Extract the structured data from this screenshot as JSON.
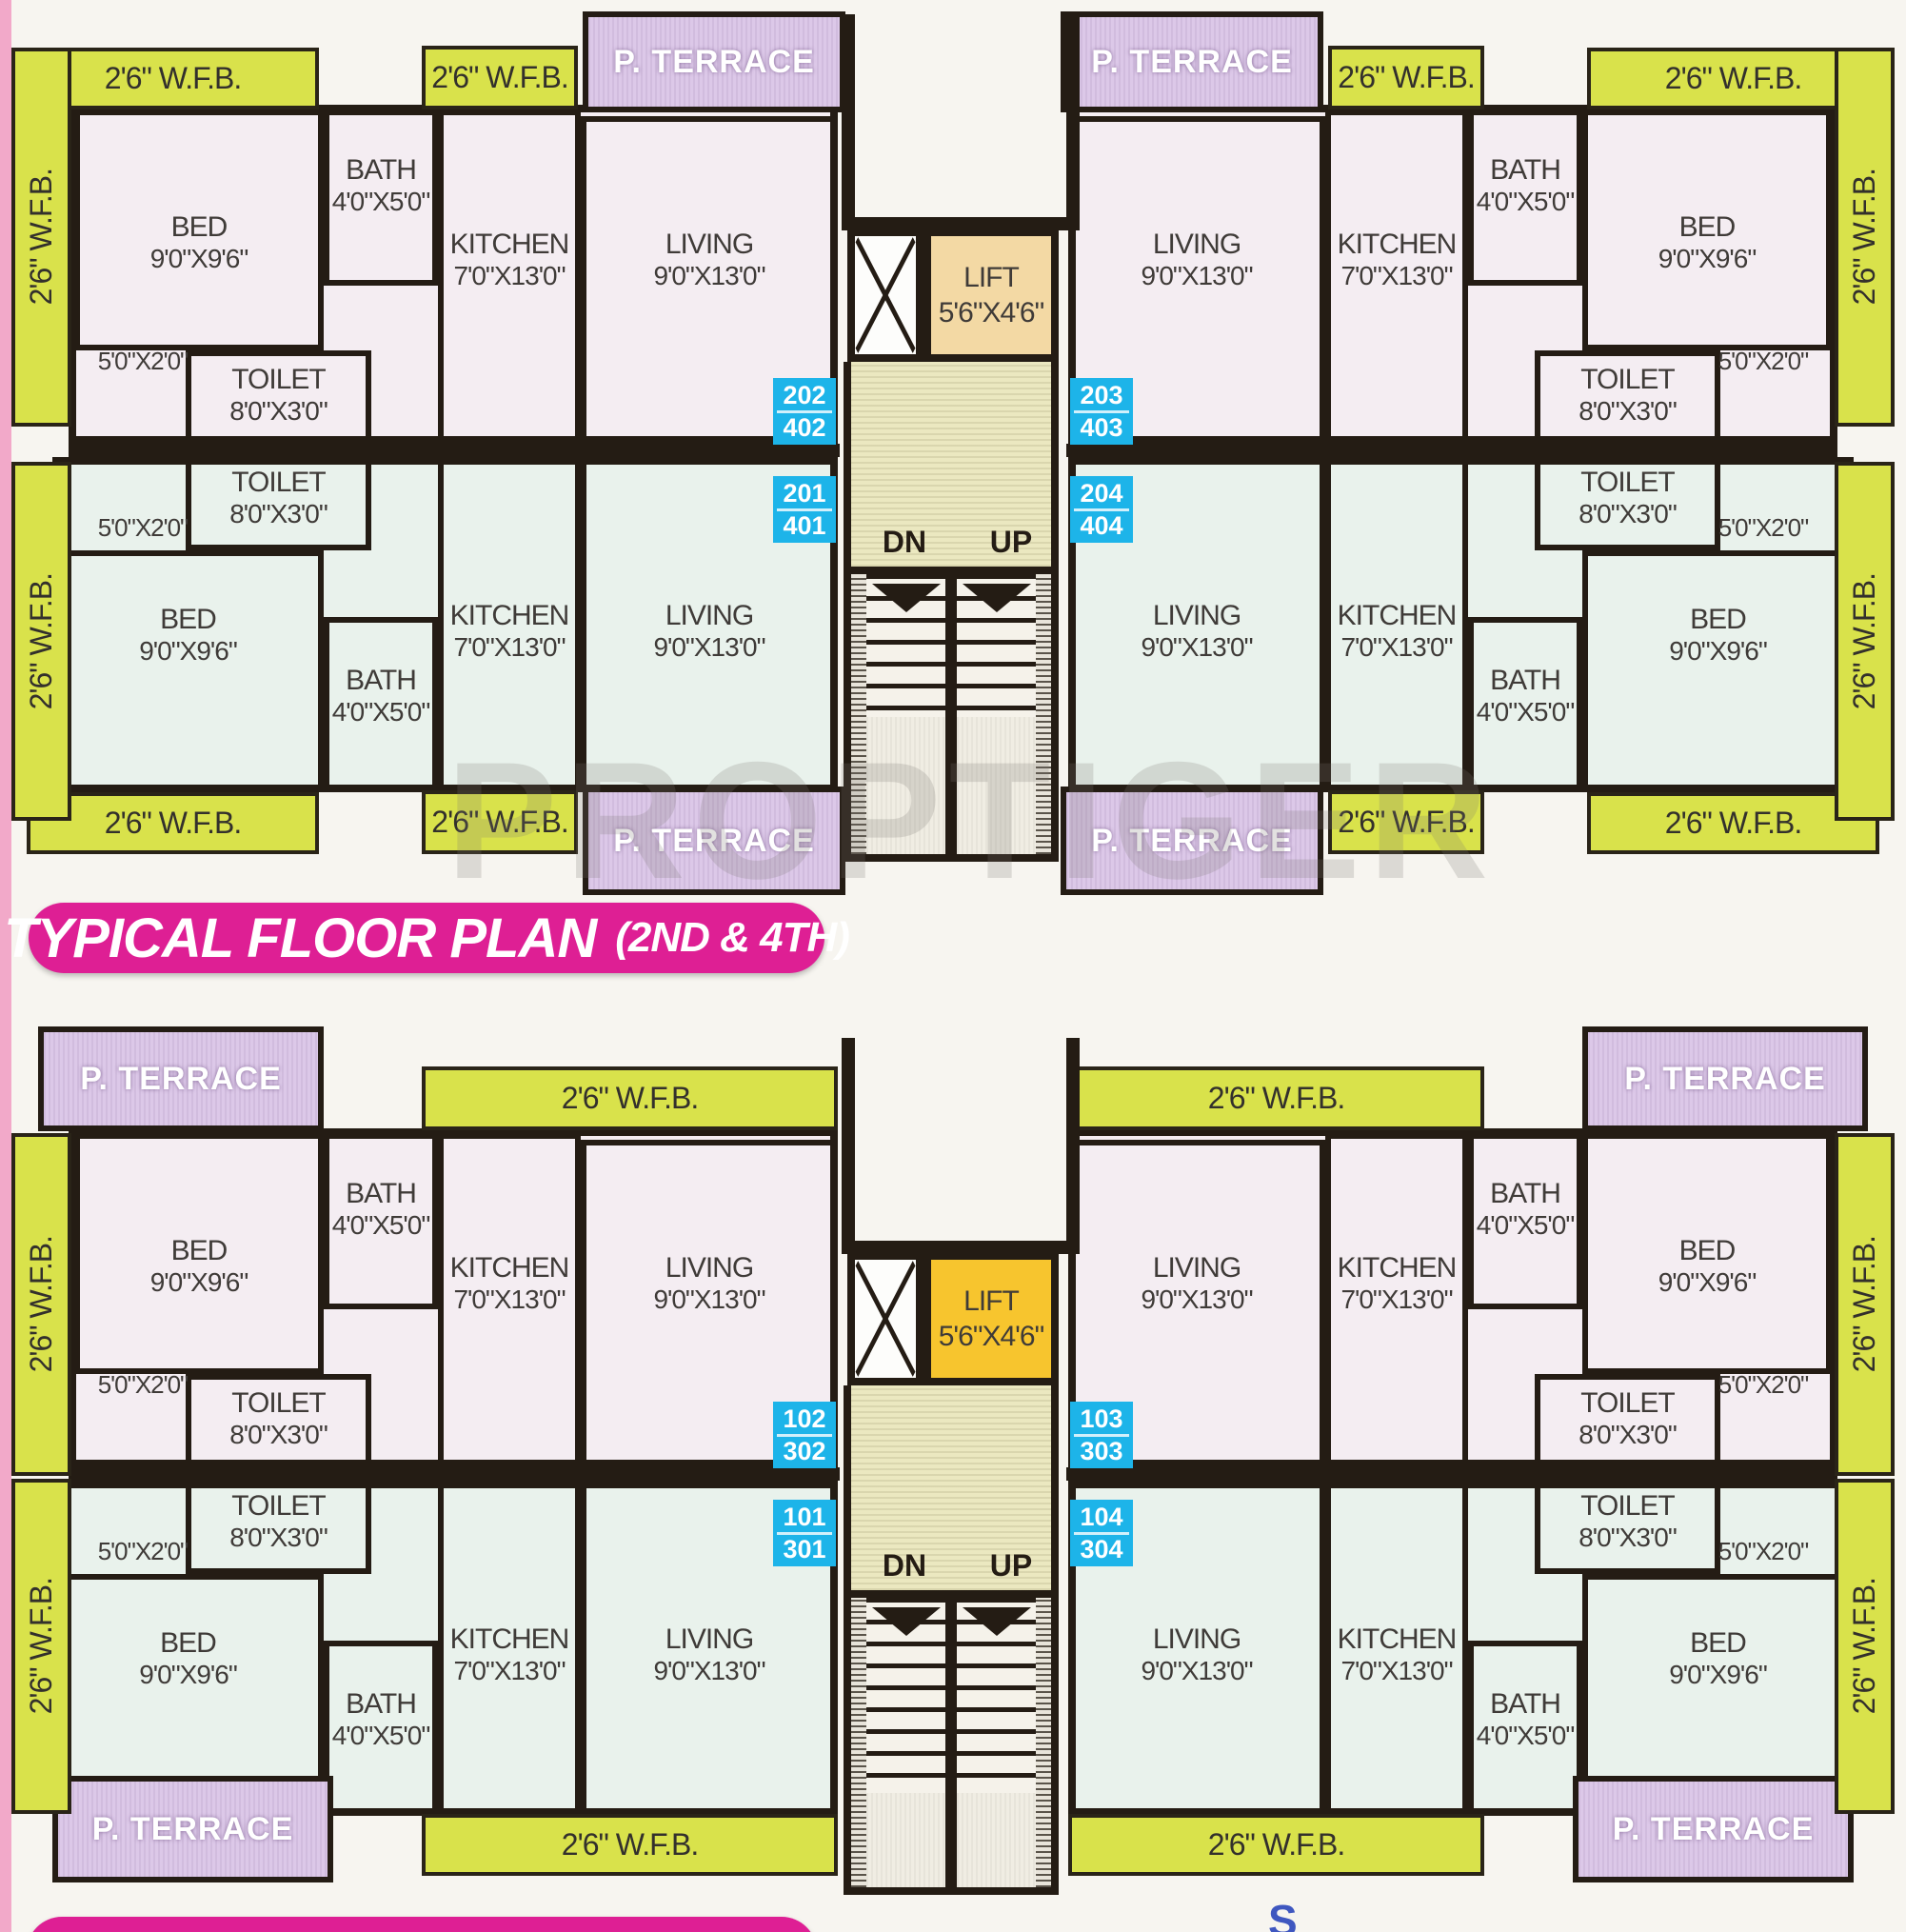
{
  "page": {
    "watermark": "PROPTIGER",
    "compass_south_label": "S"
  },
  "titles": {
    "top_plan": {
      "main": "TYPICAL FLOOR PLAN",
      "sub": "(2ND & 4TH)"
    }
  },
  "labels": {
    "wfb": "2'6\" W.F.B.",
    "terrace": "P. TERRACE",
    "lift_name": "LIFT",
    "lift_dim": "5'6\"X4'6\"",
    "stairs_down": "DN",
    "stairs_up": "UP",
    "bed_notch_dim": "5'0\"X2'0\""
  },
  "rooms": {
    "bed": {
      "name": "BED",
      "dim": "9'0\"X9'6\""
    },
    "bath": {
      "name": "BATH",
      "dim": "4'0\"X5'0\""
    },
    "kitchen": {
      "name": "KITCHEN",
      "dim": "7'0\"X13'0\""
    },
    "living": {
      "name": "LIVING",
      "dim": "9'0\"X13'0\""
    },
    "toilet": {
      "name": "TOILET",
      "dim": "8'0\"X3'0\""
    }
  },
  "plans": [
    {
      "name": "typical-floor-plan-2nd-4th",
      "units": [
        {
          "position": "top-left",
          "badge": [
            "202",
            "402"
          ]
        },
        {
          "position": "bottom-left",
          "badge": [
            "201",
            "401"
          ]
        },
        {
          "position": "top-right",
          "badge": [
            "203",
            "403"
          ]
        },
        {
          "position": "bottom-right",
          "badge": [
            "204",
            "404"
          ]
        }
      ]
    },
    {
      "name": "floor-plan-1st-3rd",
      "units": [
        {
          "position": "top-left",
          "badge": [
            "102",
            "302"
          ]
        },
        {
          "position": "bottom-left",
          "badge": [
            "101",
            "301"
          ]
        },
        {
          "position": "top-right",
          "badge": [
            "103",
            "303"
          ]
        },
        {
          "position": "bottom-right",
          "badge": [
            "104",
            "304"
          ]
        }
      ]
    }
  ],
  "colors": {
    "wall": "#241c14",
    "wfb_strip": "#d9e24b",
    "terrace": "#dcc8e8",
    "lift_plan_top": "#f3d9a4",
    "lift_plan_bottom": "#f7c52e",
    "unit_badge": "#1db4e9",
    "title_bg": "#de1f94",
    "room_tint_upper": "#f4edf2",
    "room_tint_lower": "#e9f2ec",
    "stair_core": "#ebe8c0"
  }
}
